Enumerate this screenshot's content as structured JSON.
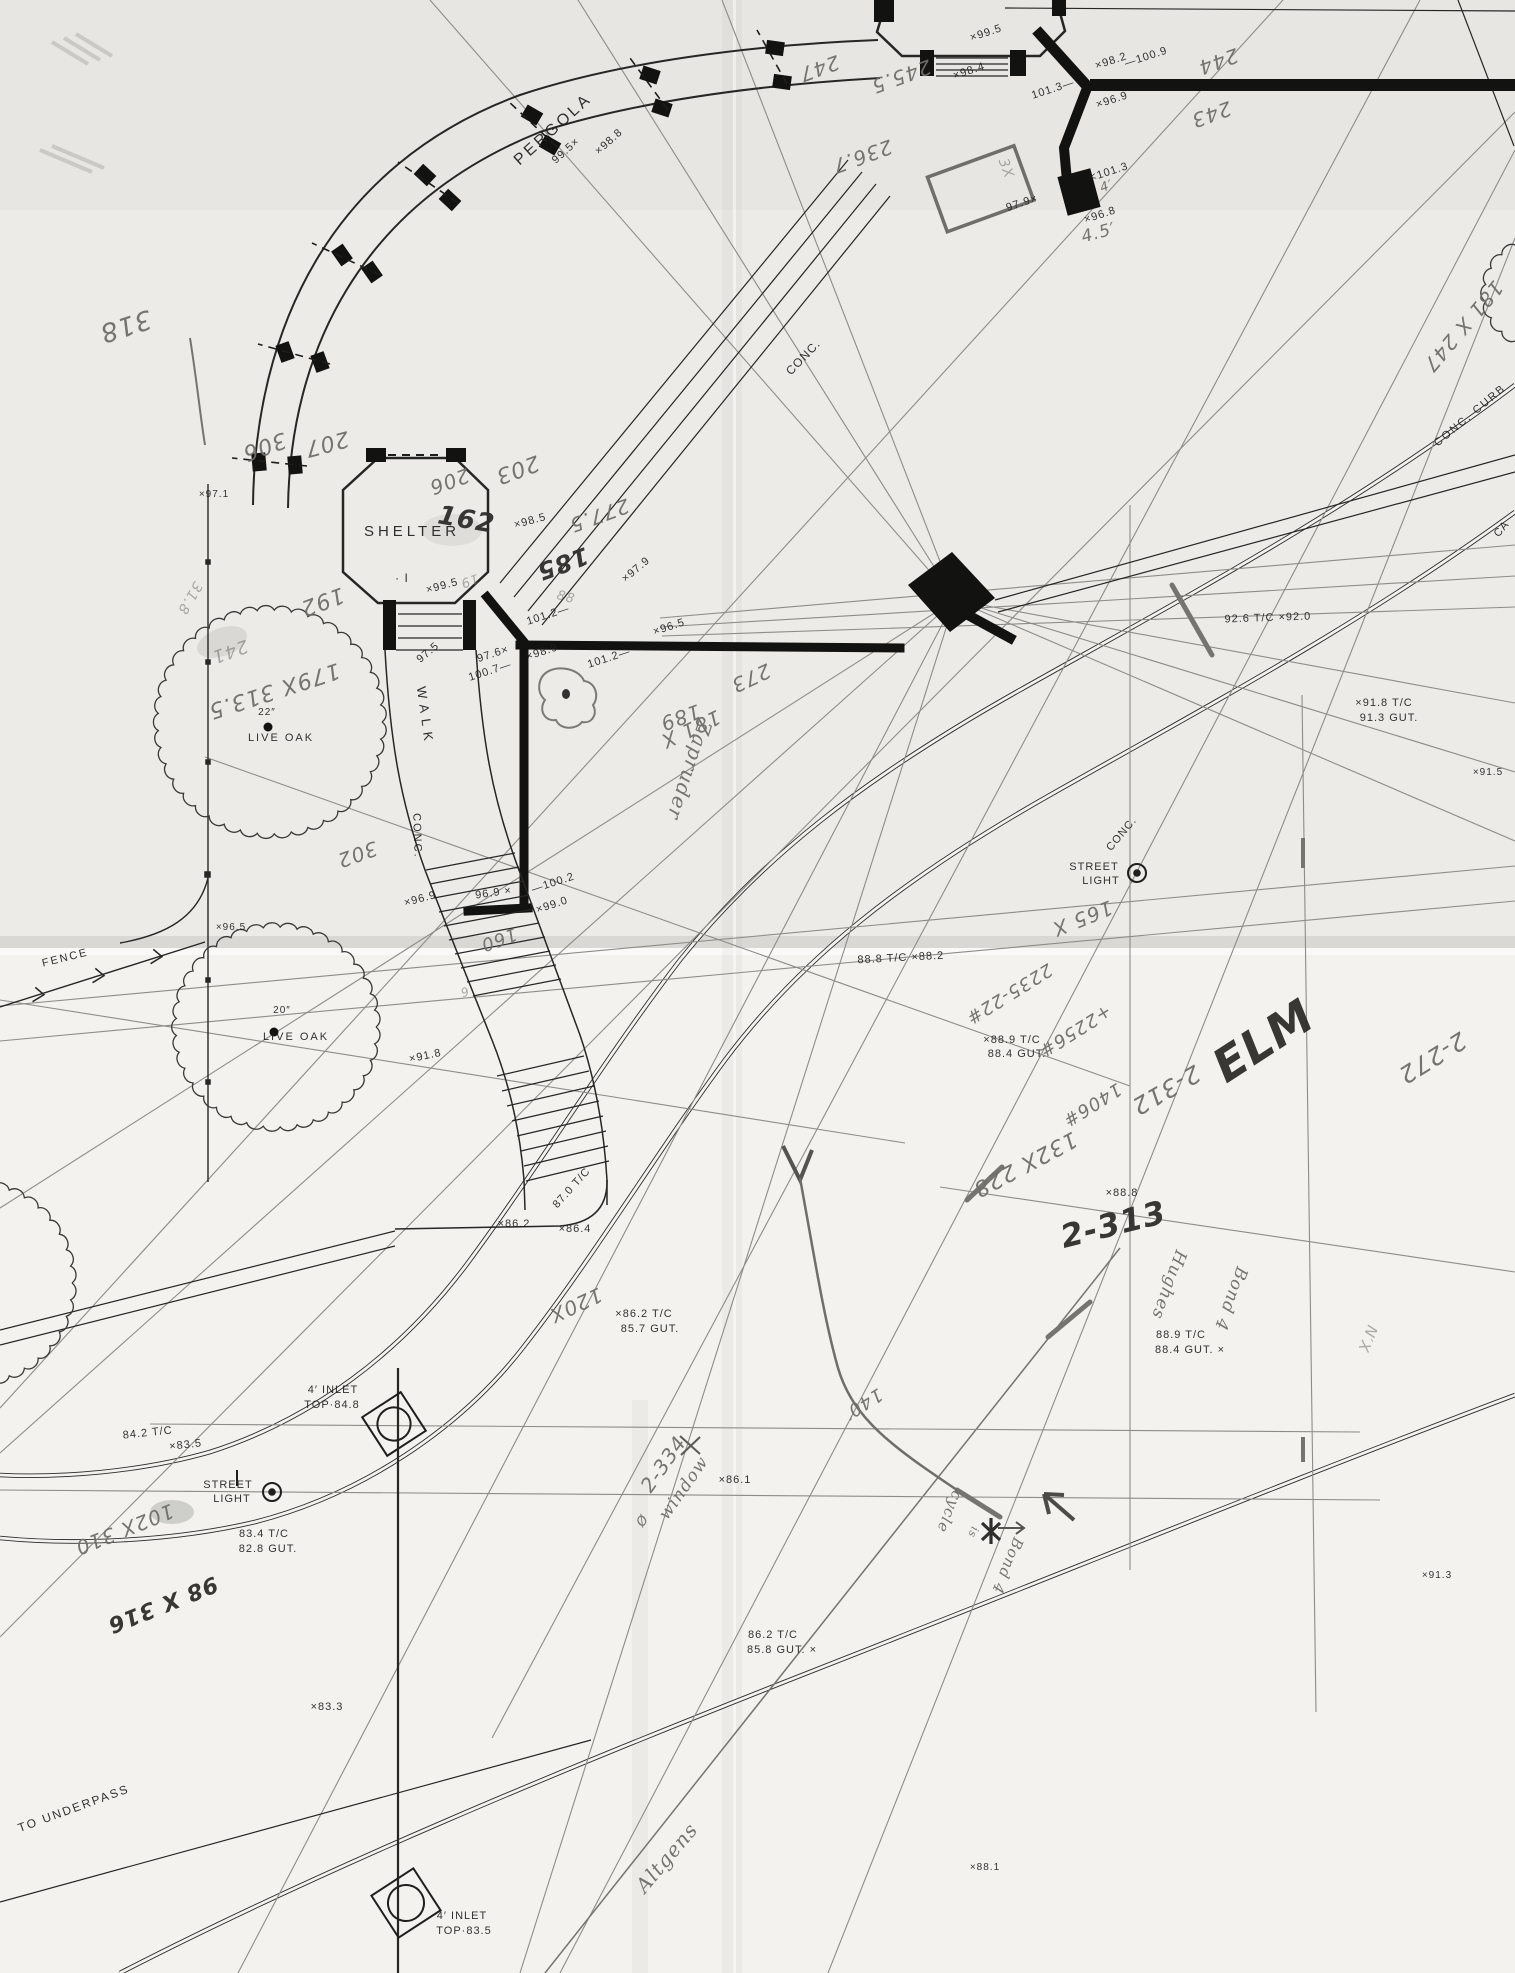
{
  "drawing": {
    "kind": "scanned survey site plan",
    "paper_color": "#f3f2ee",
    "ink_color": "#1f1f1e",
    "pencil_color": "#6f6e6a"
  },
  "printed_labels": [
    {
      "n": "label-pergola",
      "t": "PERGOLA",
      "x": 556,
      "y": 133,
      "rot": -42,
      "s": 16,
      "ls": 3
    },
    {
      "n": "spot-99-5-pergola",
      "t": "99.5×",
      "x": 568,
      "y": 153,
      "rot": -42,
      "s": 11
    },
    {
      "n": "spot-98-8-pergola",
      "t": "×98.8",
      "x": 611,
      "y": 144,
      "rot": -42,
      "s": 11
    },
    {
      "n": "label-conc-walk",
      "t": "CONC.",
      "x": 806,
      "y": 360,
      "rot": -46,
      "s": 12,
      "ls": 1
    },
    {
      "n": "spot-99-5-bandstand",
      "t": "×99.5",
      "x": 987,
      "y": 36,
      "rot": -18,
      "s": 11
    },
    {
      "n": "spot-98-4",
      "t": "×98.4",
      "x": 970,
      "y": 74,
      "rot": -18,
      "s": 11
    },
    {
      "n": "spot-101-3-wall",
      "t": "101.3—",
      "x": 1054,
      "y": 92,
      "rot": -18,
      "s": 11
    },
    {
      "n": "spot-98-2",
      "t": "×98.2",
      "x": 1112,
      "y": 64,
      "rot": -18,
      "s": 11
    },
    {
      "n": "spot-100-9",
      "t": "—100.9",
      "x": 1147,
      "y": 60,
      "rot": -18,
      "s": 11
    },
    {
      "n": "spot-96-9-ne",
      "t": "×96.9",
      "x": 1113,
      "y": 103,
      "rot": -18,
      "s": 11
    },
    {
      "n": "spot-101-3-pedestal",
      "t": "<101.3",
      "x": 1110,
      "y": 175,
      "rot": -18,
      "s": 11
    },
    {
      "n": "spot-97-9-ne",
      "t": "97.9×",
      "x": 1023,
      "y": 206,
      "rot": -18,
      "s": 11
    },
    {
      "n": "spot-96-8",
      "t": "×96.8",
      "x": 1101,
      "y": 218,
      "rot": -18,
      "s": 11
    },
    {
      "n": "label-shelter",
      "t": "SHELTER",
      "x": 412,
      "y": 536,
      "rot": 0,
      "s": 15,
      "ls": 4
    },
    {
      "n": "shelter-benchmark",
      "t": "· I",
      "x": 402,
      "y": 582,
      "rot": 0,
      "s": 12
    },
    {
      "n": "spot-98-5",
      "t": "×98.5",
      "x": 531,
      "y": 524,
      "rot": -15,
      "s": 11
    },
    {
      "n": "spot-99-5-shelter",
      "t": "×99.5",
      "x": 443,
      "y": 589,
      "rot": -15,
      "s": 11
    },
    {
      "n": "spot-97-5",
      "t": "97.5",
      "x": 430,
      "y": 655,
      "rot": -40,
      "s": 11
    },
    {
      "n": "label-walk",
      "t": "WALK",
      "x": 421,
      "y": 717,
      "rot": 82,
      "s": 13,
      "ls": 6
    },
    {
      "n": "label-conc-walk2",
      "t": "CONC.",
      "x": 414,
      "y": 836,
      "rot": 88,
      "s": 11,
      "ls": 2
    },
    {
      "n": "spot-97-1",
      "t": "×97.1",
      "x": 214,
      "y": 497,
      "rot": 0,
      "s": 10
    },
    {
      "n": "tree1-size",
      "t": "22″",
      "x": 267,
      "y": 715,
      "rot": 0,
      "s": 10
    },
    {
      "n": "tree1-name",
      "t": "LIVE OAK",
      "x": 281,
      "y": 741,
      "rot": 0,
      "s": 11,
      "ls": 2
    },
    {
      "n": "tree2-size",
      "t": "20″",
      "x": 282,
      "y": 1013,
      "rot": 0,
      "s": 10
    },
    {
      "n": "tree2-name",
      "t": "LIVE OAK",
      "x": 296,
      "y": 1040,
      "rot": 0,
      "s": 11,
      "ls": 2
    },
    {
      "n": "label-fence",
      "t": "FENCE",
      "x": 66,
      "y": 961,
      "rot": -14,
      "s": 11,
      "ls": 2
    },
    {
      "n": "spot-96-5-fence",
      "t": "×96.5",
      "x": 231,
      "y": 930,
      "rot": 0,
      "s": 10
    },
    {
      "n": "spot-96-9-stairs",
      "t": "×96.9",
      "x": 421,
      "y": 902,
      "rot": -15,
      "s": 11
    },
    {
      "n": "spot-96-9-wall",
      "t": "96.9 ×",
      "x": 494,
      "y": 896,
      "rot": -8,
      "s": 11
    },
    {
      "n": "spot-100-2",
      "t": "—100.2",
      "x": 554,
      "y": 886,
      "rot": -18,
      "s": 11
    },
    {
      "n": "spot-99-0",
      "t": "×99.0",
      "x": 553,
      "y": 908,
      "rot": -18,
      "s": 11
    },
    {
      "n": "spot-91-8-stairs",
      "t": "×91.8",
      "x": 426,
      "y": 1059,
      "rot": -12,
      "s": 11
    },
    {
      "n": "spot-97-9-wall",
      "t": "×97.9",
      "x": 638,
      "y": 572,
      "rot": -40,
      "s": 11
    },
    {
      "n": "spot-101-2-a",
      "t": "101.2—",
      "x": 549,
      "y": 618,
      "rot": -18,
      "s": 11
    },
    {
      "n": "spot-97-6",
      "t": "97.6×",
      "x": 494,
      "y": 657,
      "rot": -18,
      "s": 11
    },
    {
      "n": "spot-100-7",
      "t": "100.7—",
      "x": 491,
      "y": 674,
      "rot": -18,
      "s": 11
    },
    {
      "n": "spot-98-9",
      "t": "×98.9",
      "x": 543,
      "y": 655,
      "rot": -18,
      "s": 11
    },
    {
      "n": "spot-101-2-b",
      "t": "101.2—",
      "x": 610,
      "y": 661,
      "rot": -18,
      "s": 11
    },
    {
      "n": "spot-96-5-wall",
      "t": "×96.5",
      "x": 670,
      "y": 630,
      "rot": -18,
      "s": 11
    },
    {
      "n": "grade-87-0",
      "t": "87.0 T/C",
      "x": 574,
      "y": 1190,
      "rot": -48,
      "s": 11
    },
    {
      "n": "spot-86-2",
      "t": "×86.2",
      "x": 514,
      "y": 1227,
      "rot": 0,
      "s": 11
    },
    {
      "n": "spot-86-4",
      "t": "×86.4",
      "x": 575,
      "y": 1232,
      "rot": 0,
      "s": 11
    },
    {
      "n": "grade-86-2-tc",
      "t": "×86.2 T/C",
      "x": 644,
      "y": 1317,
      "rot": 0,
      "s": 11
    },
    {
      "n": "grade-85-7-gut",
      "t": "85.7 GUT.",
      "x": 650,
      "y": 1332,
      "rot": 0,
      "s": 11
    },
    {
      "n": "inlet1-line1",
      "t": "4′ INLET",
      "x": 333,
      "y": 1393,
      "rot": 0,
      "s": 11,
      "ls": 1
    },
    {
      "n": "inlet1-line2",
      "t": "TOP·84.8",
      "x": 332,
      "y": 1408,
      "rot": 0,
      "s": 11,
      "ls": 1
    },
    {
      "n": "grade-84-2-tc",
      "t": "84.2 T/C",
      "x": 148,
      "y": 1436,
      "rot": -6,
      "s": 11
    },
    {
      "n": "grade-83-5",
      "t": "×83.5",
      "x": 186,
      "y": 1448,
      "rot": -6,
      "s": 11
    },
    {
      "n": "streetlight2-line1",
      "t": "STREET",
      "x": 228,
      "y": 1488,
      "rot": 0,
      "s": 11,
      "ls": 1
    },
    {
      "n": "streetlight2-line2",
      "t": "LIGHT",
      "x": 232,
      "y": 1502,
      "rot": 0,
      "s": 11,
      "ls": 1
    },
    {
      "n": "grade-83-4-tc",
      "t": "83.4 T/C",
      "x": 264,
      "y": 1537,
      "rot": 0,
      "s": 11
    },
    {
      "n": "grade-82-8-gut",
      "t": "82.8 GUT.",
      "x": 268,
      "y": 1552,
      "rot": 0,
      "s": 11
    },
    {
      "n": "grade-86-2-tc-b",
      "t": "86.2 T/C",
      "x": 773,
      "y": 1638,
      "rot": 0,
      "s": 11
    },
    {
      "n": "grade-85-8-gut",
      "t": "85.8 GUT. ×",
      "x": 782,
      "y": 1653,
      "rot": 0,
      "s": 11
    },
    {
      "n": "spot-86-1",
      "t": "×86.1",
      "x": 735,
      "y": 1483,
      "rot": 0,
      "s": 11
    },
    {
      "n": "spot-83-3",
      "t": "×83.3",
      "x": 327,
      "y": 1710,
      "rot": 0,
      "s": 11
    },
    {
      "n": "label-to-underpass",
      "t": "TO UNDERPASS",
      "x": 75,
      "y": 1812,
      "rot": -20,
      "s": 12,
      "ls": 2
    },
    {
      "n": "inlet2-line1",
      "t": "4′ INLET",
      "x": 462,
      "y": 1919,
      "rot": 0,
      "s": 11,
      "ls": 1
    },
    {
      "n": "inlet2-line2",
      "t": "TOP·83.5",
      "x": 464,
      "y": 1934,
      "rot": 0,
      "s": 11,
      "ls": 1
    },
    {
      "n": "spot-88-1",
      "t": "×88.1",
      "x": 985,
      "y": 1870,
      "rot": 0,
      "s": 10
    },
    {
      "n": "spot-91-3",
      "t": "×91.3",
      "x": 1437,
      "y": 1578,
      "rot": 0,
      "s": 10
    },
    {
      "n": "spot-91-5",
      "t": "×91.5",
      "x": 1488,
      "y": 775,
      "rot": 0,
      "s": 10
    },
    {
      "n": "grade-92-6",
      "t": "92.6 T/C ×92.0",
      "x": 1268,
      "y": 621,
      "rot": -2,
      "s": 11
    },
    {
      "n": "grade-91-8-tc",
      "t": "×91.8 T/C",
      "x": 1384,
      "y": 706,
      "rot": 0,
      "s": 11
    },
    {
      "n": "grade-91-3-gut",
      "t": "91.3 GUT.",
      "x": 1389,
      "y": 721,
      "rot": 0,
      "s": 11
    },
    {
      "n": "label-conc-curb",
      "t": "CONC. CURB",
      "x": 1472,
      "y": 418,
      "rot": -40,
      "s": 11,
      "ls": 2
    },
    {
      "n": "label-conc-elm",
      "t": "CONC.",
      "x": 1124,
      "y": 836,
      "rot": -50,
      "s": 11,
      "ls": 1
    },
    {
      "n": "streetlight1-line1",
      "t": "STREET",
      "x": 1094,
      "y": 870,
      "rot": 0,
      "s": 11,
      "ls": 1
    },
    {
      "n": "streetlight1-line2",
      "t": "LIGHT",
      "x": 1101,
      "y": 884,
      "rot": 0,
      "s": 11,
      "ls": 1
    },
    {
      "n": "grade-88-8-tc",
      "t": "88.8 T/C ×88.2",
      "x": 901,
      "y": 961,
      "rot": -3,
      "s": 11
    },
    {
      "n": "grade-88-9-tc-a",
      "t": "×88.9 T/C",
      "x": 1012,
      "y": 1043,
      "rot": 0,
      "s": 11
    },
    {
      "n": "grade-88-4-gut-a",
      "t": "88.4 GUT.",
      "x": 1017,
      "y": 1057,
      "rot": 0,
      "s": 11
    },
    {
      "n": "spot-88-8",
      "t": "×88.8",
      "x": 1122,
      "y": 1196,
      "rot": 0,
      "s": 11
    },
    {
      "n": "grade-88-9-tc-b",
      "t": "88.9 T/C",
      "x": 1181,
      "y": 1338,
      "rot": 0,
      "s": 11
    },
    {
      "n": "grade-88-4-gut-b",
      "t": "88.4 GUT. ×",
      "x": 1190,
      "y": 1353,
      "rot": 0,
      "s": 11
    },
    {
      "n": "label-ca-partial",
      "t": "CA",
      "x": 1504,
      "y": 531,
      "rot": -50,
      "s": 11
    }
  ],
  "handwritten_labels": [
    {
      "n": "hw-318",
      "t": "318",
      "x": 123,
      "y": 318,
      "rot": 162,
      "s": 26
    },
    {
      "n": "hw-207",
      "t": "207",
      "x": 325,
      "y": 437,
      "rot": 165,
      "s": 22
    },
    {
      "n": "hw-206",
      "t": "206",
      "x": 447,
      "y": 475,
      "rot": 160,
      "s": 20
    },
    {
      "n": "hw-203",
      "t": "203",
      "x": 515,
      "y": 463,
      "rot": 160,
      "s": 22
    },
    {
      "n": "hw-306",
      "t": "306",
      "x": 262,
      "y": 440,
      "rot": 160,
      "s": 22
    },
    {
      "n": "hw-192",
      "t": "192",
      "x": 320,
      "y": 595,
      "rot": 160,
      "s": 22
    },
    {
      "n": "hw-241",
      "t": "241",
      "x": 228,
      "y": 646,
      "rot": 160,
      "s": 18,
      "light": true
    },
    {
      "n": "hw-179x-313-5",
      "t": "179X 313.5",
      "x": 272,
      "y": 684,
      "rot": 162,
      "s": 22
    },
    {
      "n": "hw-31-8",
      "t": "31.8",
      "x": 186,
      "y": 596,
      "rot": 120,
      "s": 14,
      "light": true
    },
    {
      "n": "hw-302",
      "t": "302",
      "x": 355,
      "y": 848,
      "rot": 160,
      "s": 20
    },
    {
      "n": "hw-162",
      "t": "162",
      "x": 465,
      "y": 528,
      "rot": 10,
      "s": 26,
      "dark": true
    },
    {
      "n": "hw-277-5",
      "t": "277.5",
      "x": 597,
      "y": 509,
      "rot": 160,
      "s": 20
    },
    {
      "n": "hw-185",
      "t": "185",
      "x": 560,
      "y": 556,
      "rot": 160,
      "s": 24,
      "dark": true
    },
    {
      "n": "hw-19",
      "t": "19",
      "x": 468,
      "y": 577,
      "rot": 160,
      "s": 13,
      "light": true
    },
    {
      "n": "hw-88",
      "t": "88",
      "x": 565,
      "y": 601,
      "rot": 15,
      "s": 13,
      "light": true
    },
    {
      "n": "hw-189",
      "t": "189",
      "x": 678,
      "y": 711,
      "rot": 160,
      "s": 20
    },
    {
      "n": "hw-273",
      "t": "273",
      "x": 748,
      "y": 672,
      "rot": 155,
      "s": 20
    },
    {
      "n": "hw-181x",
      "t": "181 X",
      "x": 688,
      "y": 723,
      "rot": 155,
      "s": 20
    },
    {
      "n": "hw-zapruder",
      "t": "Zapruder",
      "x": 683,
      "y": 768,
      "rot": 108,
      "s": 20,
      "cursive": true
    },
    {
      "n": "hw-245-5",
      "t": "245.5",
      "x": 899,
      "y": 70,
      "rot": 160,
      "s": 20
    },
    {
      "n": "hw-247",
      "t": "247",
      "x": 817,
      "y": 62,
      "rot": 160,
      "s": 20
    },
    {
      "n": "hw-236-7",
      "t": "236.7",
      "x": 860,
      "y": 150,
      "rot": 160,
      "s": 20
    },
    {
      "n": "hw-244",
      "t": "244",
      "x": 1216,
      "y": 55,
      "rot": 160,
      "s": 20
    },
    {
      "n": "hw-243",
      "t": "243",
      "x": 1209,
      "y": 108,
      "rot": 160,
      "s": 20
    },
    {
      "n": "hw-3x",
      "t": "3X",
      "x": 1002,
      "y": 170,
      "rot": 70,
      "s": 14,
      "light": true
    },
    {
      "n": "hw-4ft",
      "t": "4′",
      "x": 1108,
      "y": 190,
      "rot": -20,
      "s": 13
    },
    {
      "n": "hw-4-5ft",
      "t": "4.5′",
      "x": 1100,
      "y": 238,
      "rot": -15,
      "s": 17
    },
    {
      "n": "hw-181x247",
      "t": "181 X 247",
      "x": 1458,
      "y": 322,
      "rot": 130,
      "s": 20
    },
    {
      "n": "hw-165x",
      "t": "165 X",
      "x": 1080,
      "y": 912,
      "rot": 158,
      "s": 20
    },
    {
      "n": "hw-2235-22",
      "t": "2235-22#",
      "x": 1006,
      "y": 989,
      "rot": 148,
      "s": 18
    },
    {
      "n": "hw-2256",
      "t": "+2256#",
      "x": 1072,
      "y": 1026,
      "rot": 148,
      "s": 18
    },
    {
      "n": "hw-1406",
      "t": "1406#",
      "x": 1089,
      "y": 1100,
      "rot": 148,
      "s": 18
    },
    {
      "n": "hw-2-312",
      "t": "2-312",
      "x": 1162,
      "y": 1083,
      "rot": 150,
      "s": 24
    },
    {
      "n": "hw-elm",
      "t": "ELM",
      "x": 1272,
      "y": 1054,
      "rot": -33,
      "s": 46,
      "dark": true
    },
    {
      "n": "hw-2-272",
      "t": "2-272",
      "x": 1428,
      "y": 1051,
      "rot": 148,
      "s": 24
    },
    {
      "n": "hw-132x-228",
      "t": "132X 228",
      "x": 1022,
      "y": 1158,
      "rot": 152,
      "s": 22
    },
    {
      "n": "hw-2-313",
      "t": "2-313",
      "x": 1116,
      "y": 1235,
      "rot": -14,
      "s": 32,
      "dark": true
    },
    {
      "n": "hw-hughes",
      "t": "Hughes",
      "x": 1164,
      "y": 1283,
      "rot": 110,
      "s": 17,
      "cursive": true
    },
    {
      "n": "hw-bond4-a",
      "t": "Bond 4",
      "x": 1226,
      "y": 1297,
      "rot": 110,
      "s": 17,
      "cursive": true
    },
    {
      "n": "hw-nx",
      "t": "N′X",
      "x": 1363,
      "y": 1337,
      "rot": 112,
      "s": 15,
      "light": true
    },
    {
      "n": "hw-120x",
      "t": "120X",
      "x": 573,
      "y": 1299,
      "rot": 155,
      "s": 20
    },
    {
      "n": "hw-140ft",
      "t": "140′",
      "x": 860,
      "y": 1399,
      "rot": 148,
      "s": 18
    },
    {
      "n": "hw-2-334",
      "t": "2-334",
      "x": 669,
      "y": 1468,
      "rot": -55,
      "s": 20
    },
    {
      "n": "hw-window",
      "t": "window",
      "x": 688,
      "y": 1491,
      "rot": -55,
      "s": 17,
      "cursive": true
    },
    {
      "n": "hw-window-symbol",
      "t": "Ø",
      "x": 646,
      "y": 1523,
      "rot": -55,
      "s": 13
    },
    {
      "n": "hw-cycle",
      "t": "cycle",
      "x": 945,
      "y": 1510,
      "rot": 112,
      "s": 15,
      "cursive": true
    },
    {
      "n": "hw-is",
      "t": "is",
      "x": 970,
      "y": 1531,
      "rot": 112,
      "s": 11,
      "cursive": true
    },
    {
      "n": "hw-bond4-b",
      "t": "Bond 4",
      "x": 1003,
      "y": 1564,
      "rot": 112,
      "s": 15,
      "cursive": true
    },
    {
      "n": "hw-altgens",
      "t": "Altgens",
      "x": 672,
      "y": 1862,
      "rot": -50,
      "s": 20,
      "cursive": true
    },
    {
      "n": "hw-102x-310",
      "t": "102X 310",
      "x": 122,
      "y": 1523,
      "rot": 158,
      "s": 20
    },
    {
      "n": "hw-98x-316",
      "t": "98 X 316",
      "x": 160,
      "y": 1598,
      "rot": 158,
      "s": 22,
      "dark": true
    },
    {
      "n": "hw-160",
      "t": "160",
      "x": 497,
      "y": 934,
      "rot": 160,
      "s": 18
    },
    {
      "n": "hw-6",
      "t": "6",
      "x": 463,
      "y": 988,
      "rot": 160,
      "s": 12,
      "light": true
    }
  ],
  "features": {
    "trees": [
      {
        "n": "live-oak-22in",
        "cx": 270,
        "cy": 722,
        "r": 112,
        "dot": true
      },
      {
        "n": "live-oak-20in",
        "cx": 276,
        "cy": 1027,
        "r": 100,
        "dot": true
      },
      {
        "n": "tree-partial-left-edge",
        "cx": -28,
        "cy": 1283,
        "r": 100,
        "dot": false
      },
      {
        "n": "tree-partial-top-right",
        "cx": 1537,
        "cy": 293,
        "r": 52,
        "dot": false
      }
    ],
    "street_lights": [
      {
        "n": "street-light-elm",
        "x": 1137,
        "y": 873
      },
      {
        "n": "street-light-lower",
        "x": 272,
        "y": 1492,
        "flag": true
      }
    ],
    "inlets": [
      {
        "n": "inlet-4ft-top-84-8",
        "x": 394,
        "y": 1424,
        "s": 46,
        "rot": -33
      },
      {
        "n": "inlet-4ft-top-83-5",
        "x": 406,
        "y": 1903,
        "s": 50,
        "rot": -33
      }
    ]
  }
}
